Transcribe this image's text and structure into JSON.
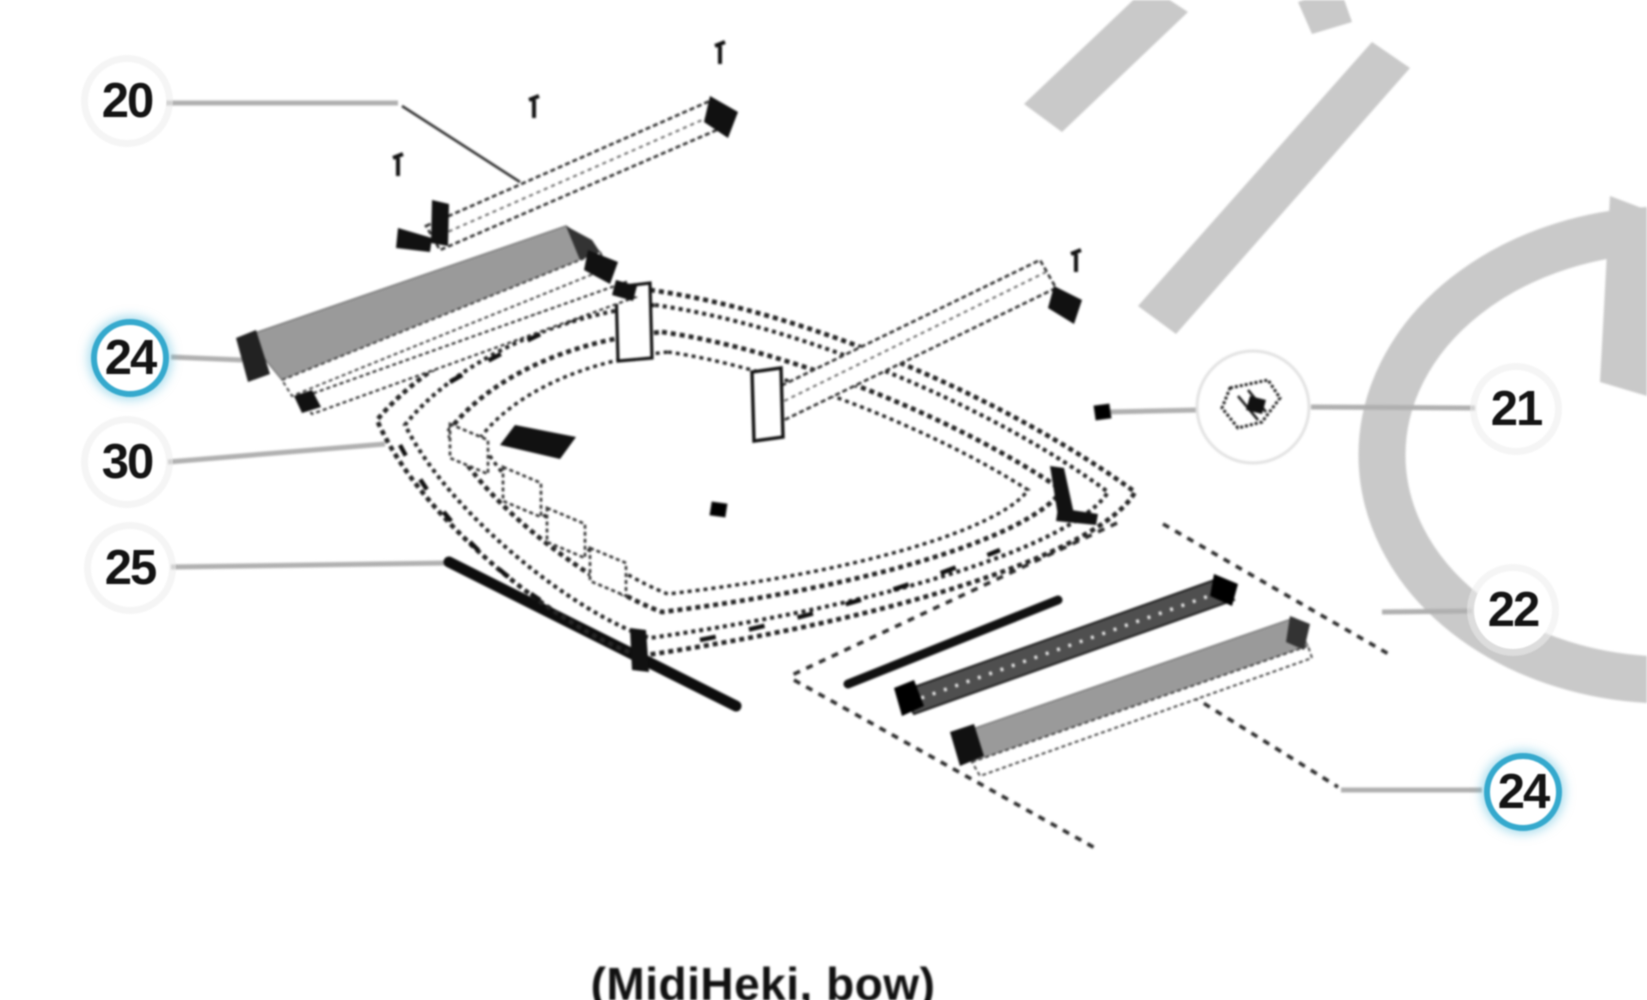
{
  "figure": {
    "caption": "(MidiHeki, bow)"
  },
  "callouts": {
    "c20": {
      "label": "20",
      "highlighted": false
    },
    "c24_left": {
      "label": "24",
      "highlighted": true
    },
    "c30": {
      "label": "30",
      "highlighted": false
    },
    "c25": {
      "label": "25",
      "highlighted": false
    },
    "c21": {
      "label": "21",
      "highlighted": false
    },
    "c22": {
      "label": "22",
      "highlighted": false
    },
    "c24_right": {
      "label": "24",
      "highlighted": true
    }
  },
  "colors": {
    "highlight_ring": "#35a9cd",
    "leader_line": "#b0b0b0",
    "part_fill_gray": "#9a9a9a",
    "watermark_gray": "#c9c9c9",
    "line_dark": "#1a1a1a",
    "background": "#ffffff"
  }
}
